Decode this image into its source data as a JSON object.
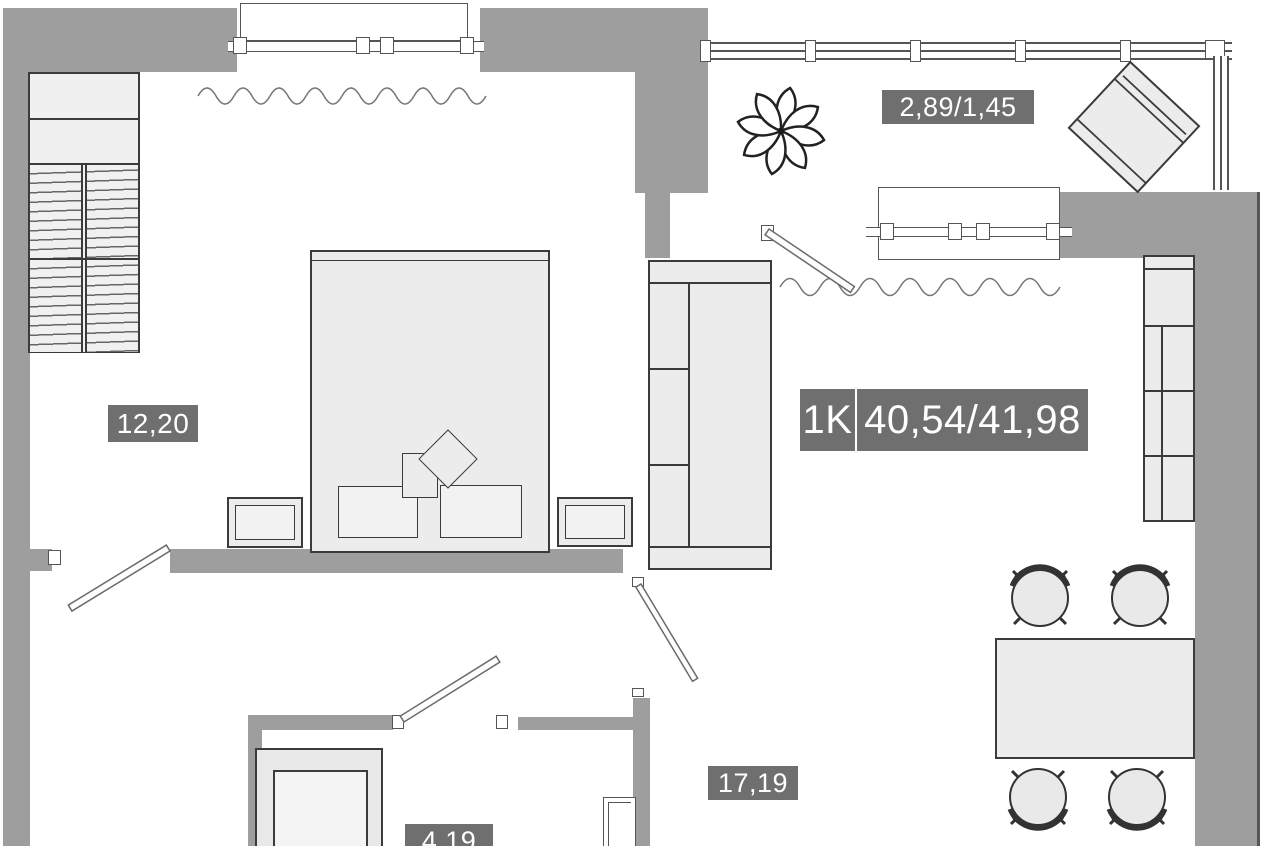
{
  "apartment": {
    "type": "1K",
    "total_area": "40,54/41,98"
  },
  "rooms": [
    {
      "id": "bedroom",
      "area": "12,20"
    },
    {
      "id": "kitchen-living-room",
      "area": "17,19"
    },
    {
      "id": "bathroom",
      "area": "4,19"
    },
    {
      "id": "balcony",
      "area": "2,89/1,45"
    }
  ],
  "colors": {
    "wall": "#9e9e9e",
    "area_badge": "#6f6f6f",
    "furniture_fill": "#ececec",
    "furniture_outline": "#3b3b3b"
  },
  "furniture": [
    "wardrobe",
    "double-bed",
    "pillows",
    "nightstand-left",
    "nightstand-right",
    "sofa",
    "plant",
    "armchair",
    "kitchen-counter",
    "dining-table",
    "four-chairs",
    "shower-cabin"
  ]
}
